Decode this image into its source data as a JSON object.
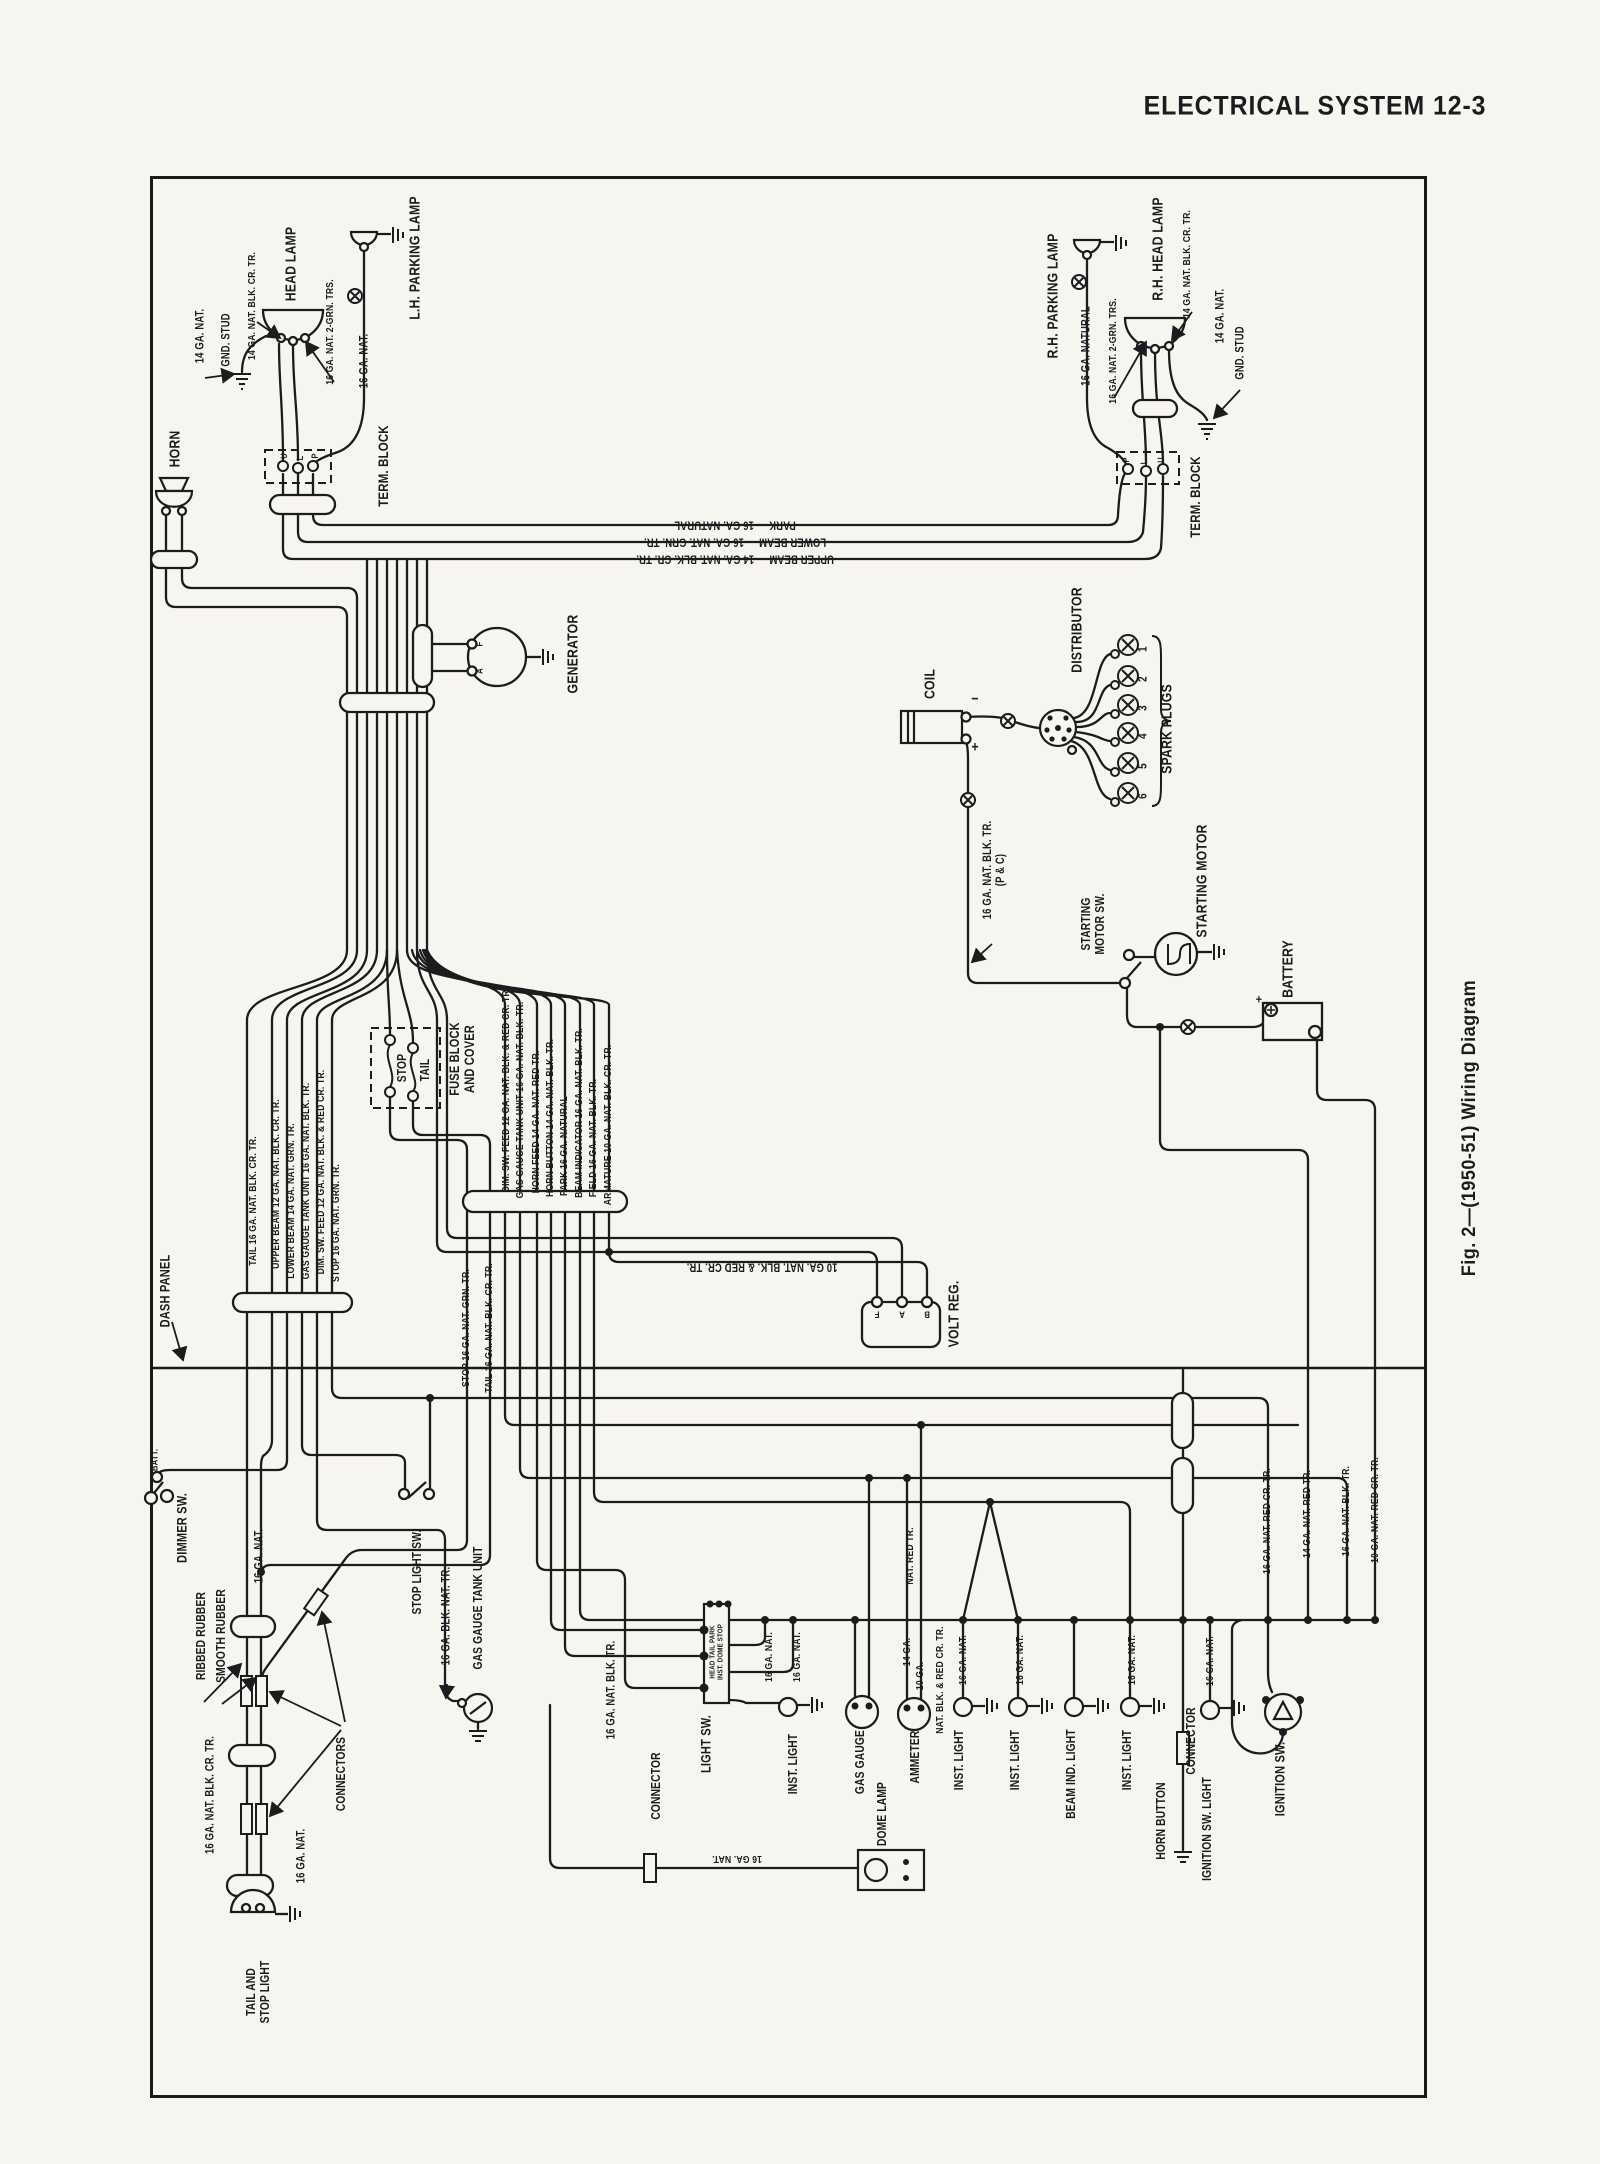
{
  "page": {
    "header": "ELECTRICAL SYSTEM 12-3",
    "caption": "Fig. 2—(1950-51) Wiring Diagram",
    "paper_color": "#f7f5f0",
    "ink_color": "#1c1b1d"
  },
  "labels": [
    {
      "t": "HEAD LAMP",
      "x": 292,
      "y": 264,
      "s": 15,
      "n": "lh-head-lamp-label"
    },
    {
      "t": "L.H. PARKING LAMP",
      "x": 416,
      "y": 258,
      "s": 15,
      "n": "lh-parking-lamp-label"
    },
    {
      "t": "14 GA. NAT.",
      "x": 201,
      "y": 336
    },
    {
      "t": "GND. STUD",
      "x": 227,
      "y": 340,
      "n": "lh-ground-stud-label"
    },
    {
      "t": "14 GA. NAT. BLK. CR. TR.",
      "x": 253,
      "y": 306,
      "s": 10.5
    },
    {
      "t": "16 GA. NAT. 2-GRN. TRS.",
      "x": 331,
      "y": 332,
      "s": 10.5
    },
    {
      "t": "16 GA. NAT.",
      "x": 365,
      "y": 361
    },
    {
      "t": "HORN",
      "x": 176,
      "y": 449,
      "s": 15,
      "n": "horn-label"
    },
    {
      "t": "TERM. BLOCK",
      "x": 384,
      "y": 466,
      "s": 14,
      "n": "lh-term-block-label"
    },
    {
      "t": "U",
      "x": 284,
      "y": 456,
      "s": 9
    },
    {
      "t": "L",
      "x": 300,
      "y": 458,
      "s": 9
    },
    {
      "t": "P",
      "x": 315,
      "y": 456,
      "s": 9
    },
    {
      "t": "PARK — 16 GA. NATURAL",
      "x": 735,
      "y": 524,
      "r": 180
    },
    {
      "t": "LOWER BEAM — 16 GA. NAT. GRN. TR.",
      "x": 735,
      "y": 541,
      "r": 180
    },
    {
      "t": "UPPER BEAM — 14 GA. NAT. BLK. CR. TR.",
      "x": 735,
      "y": 558,
      "r": 180
    },
    {
      "t": "GENERATOR",
      "x": 574,
      "y": 654,
      "s": 15,
      "n": "generator-label"
    },
    {
      "t": "F",
      "x": 481,
      "y": 644,
      "s": 9.5
    },
    {
      "t": "A",
      "x": 481,
      "y": 671,
      "s": 9.5
    },
    {
      "t": "R.H. PARKING LAMP",
      "x": 1054,
      "y": 296,
      "s": 15,
      "n": "rh-parking-lamp-label"
    },
    {
      "t": "R.H. HEAD LAMP",
      "x": 1159,
      "y": 249,
      "s": 15,
      "n": "rh-head-lamp-label"
    },
    {
      "t": "16 GA. NATURAL",
      "x": 1087,
      "y": 346
    },
    {
      "t": "16 GA. NAT. 2-GRN. TRS.",
      "x": 1114,
      "y": 351,
      "s": 10.5
    },
    {
      "t": "14 GA. NAT. BLK. CR. TR.",
      "x": 1188,
      "y": 264,
      "s": 10.5
    },
    {
      "t": "14 GA. NAT.",
      "x": 1221,
      "y": 316
    },
    {
      "t": "GND. STUD",
      "x": 1241,
      "y": 353,
      "n": "rh-ground-stud-label"
    },
    {
      "t": "TERM. BLOCK",
      "x": 1196,
      "y": 497,
      "s": 14,
      "n": "rh-term-block-label"
    },
    {
      "t": "P",
      "x": 1126,
      "y": 460,
      "s": 9
    },
    {
      "t": "L",
      "x": 1144,
      "y": 462,
      "s": 9
    },
    {
      "t": "U",
      "x": 1161,
      "y": 460,
      "s": 9
    },
    {
      "t": "COIL",
      "x": 931,
      "y": 684,
      "s": 15,
      "n": "coil-label"
    },
    {
      "t": "−",
      "x": 975,
      "y": 700,
      "r": 0,
      "s": 15
    },
    {
      "t": "+",
      "x": 975,
      "y": 748,
      "r": 0,
      "s": 15
    },
    {
      "t": "DISTRIBUTOR",
      "x": 1078,
      "y": 630,
      "s": 15,
      "n": "distributor-label"
    },
    {
      "t": "SPARK PLUGS",
      "x": 1168,
      "y": 729,
      "s": 15,
      "n": "spark-plugs-label"
    },
    {
      "t": "1",
      "x": 1143,
      "y": 649,
      "s": 12
    },
    {
      "t": "2",
      "x": 1143,
      "y": 679,
      "s": 12
    },
    {
      "t": "3",
      "x": 1143,
      "y": 708,
      "s": 12
    },
    {
      "t": "4",
      "x": 1143,
      "y": 736,
      "s": 12
    },
    {
      "t": "5",
      "x": 1143,
      "y": 766,
      "s": 12
    },
    {
      "t": "6",
      "x": 1143,
      "y": 796,
      "s": 12
    },
    {
      "t": "16 GA. NAT. BLK. TR.\n(P & C)",
      "x": 995,
      "y": 870
    },
    {
      "t": "STARTING\nMOTOR SW.",
      "x": 1093,
      "y": 924,
      "s": 12.5,
      "n": "starting-motor-switch-label"
    },
    {
      "t": "STARTING MOTOR",
      "x": 1203,
      "y": 881,
      "s": 15,
      "n": "starting-motor-label"
    },
    {
      "t": "BATTERY",
      "x": 1289,
      "y": 969,
      "s": 15,
      "n": "battery-label"
    },
    {
      "t": "+",
      "x": 1259,
      "y": 1000,
      "r": 0,
      "s": 13
    },
    {
      "t": "VOLT REG.",
      "x": 955,
      "y": 1314,
      "s": 15,
      "n": "voltage-regulator-label"
    },
    {
      "t": "10 GA. NAT. BLK. & RED CR. TR.",
      "x": 762,
      "y": 1266,
      "r": 180
    },
    {
      "t": "F",
      "x": 877,
      "y": 1313,
      "r": 180,
      "s": 9.5
    },
    {
      "t": "A",
      "x": 902,
      "y": 1313,
      "r": 180,
      "s": 9.5
    },
    {
      "t": "B",
      "x": 927,
      "y": 1313,
      "r": 180,
      "s": 9.5
    },
    {
      "t": "STOP",
      "x": 402,
      "y": 1068,
      "s": 12.5
    },
    {
      "t": "TAIL",
      "x": 425,
      "y": 1070,
      "s": 12.5
    },
    {
      "t": "FUSE BLOCK\nAND COVER",
      "x": 462,
      "y": 1059,
      "s": 13.5,
      "n": "fuse-block-label"
    },
    {
      "t": "DIM. SW. FEED 12 GA. NAT. BLK. & RED CR. TR.",
      "x": 507,
      "y": 1090,
      "s": 10.5
    },
    {
      "t": "GAS GAUGE TANK UNIT 16 GA. NAT. BLK. TR.",
      "x": 521,
      "y": 1100,
      "s": 10.5
    },
    {
      "t": "HORN FEED 14 GA. NAT. RED TR.",
      "x": 537,
      "y": 1122,
      "s": 10.5
    },
    {
      "t": "HORN BUTTON 14 GA. NAT. BLK. TR.",
      "x": 551,
      "y": 1118,
      "s": 10.5
    },
    {
      "t": "PARK 16 GA. NATURAL",
      "x": 565,
      "y": 1146,
      "s": 10.5
    },
    {
      "t": "BEAM INDICATOR 16 GA. NAT. BLK. TR.",
      "x": 580,
      "y": 1113,
      "s": 10.5
    },
    {
      "t": "FIELD 16 GA. NAT. BLK. TR.",
      "x": 594,
      "y": 1138,
      "s": 10.5
    },
    {
      "t": "ARMATURE 10 GA. NAT. BLK. CR. TR.",
      "x": 609,
      "y": 1125,
      "s": 10.5
    },
    {
      "t": "TAIL 16 GA. NAT. BLK. CR. TR.",
      "x": 254,
      "y": 1201,
      "s": 10.5
    },
    {
      "t": "UPPER BEAM 12 GA. NAT. BLK. CR. TR.",
      "x": 277,
      "y": 1184,
      "s": 10.5
    },
    {
      "t": "LOWER BEAM 14 GA. NAT. GRN. TR.",
      "x": 292,
      "y": 1201,
      "s": 10.5
    },
    {
      "t": "GAS GAUGE TANK UNIT 16 GA. NAT. BLK. TR.",
      "x": 307,
      "y": 1181,
      "s": 10.5
    },
    {
      "t": "DIM. SW. FEED 12 GA. NAT. BLK. & RED CR. TR.",
      "x": 322,
      "y": 1172,
      "s": 10.5
    },
    {
      "t": "STOP 16 GA. NAT. GRN. TR.",
      "x": 337,
      "y": 1223,
      "s": 10.5
    },
    {
      "t": "DASH PANEL",
      "x": 165,
      "y": 1291,
      "s": 13.5,
      "n": "dash-panel-label"
    },
    {
      "t": "BATT.",
      "x": 156,
      "y": 1460,
      "s": 9.5
    },
    {
      "t": "DIMMER SW.",
      "x": 182,
      "y": 1528,
      "s": 13.5,
      "n": "dimmer-switch-label"
    },
    {
      "t": "16 GA. NAT.",
      "x": 260,
      "y": 1556
    },
    {
      "t": "STOP 16 GA. NAT. GRN. TR.",
      "x": 467,
      "y": 1328,
      "s": 10.5
    },
    {
      "t": "TAIL 16 GA. NAT. BLK. CR. TR.",
      "x": 490,
      "y": 1328,
      "s": 10.5
    },
    {
      "t": "RIBBED RUBBER",
      "x": 201,
      "y": 1636,
      "s": 12.5
    },
    {
      "t": "SMOOTH RUBBER",
      "x": 221,
      "y": 1636,
      "s": 12.5
    },
    {
      "t": "16 GA. NAT. BLK. CR. TR.",
      "x": 211,
      "y": 1795
    },
    {
      "t": "16 GA. NAT.",
      "x": 302,
      "y": 1856
    },
    {
      "t": "CONNECTORS",
      "x": 341,
      "y": 1774,
      "s": 12.5,
      "n": "connectors-label"
    },
    {
      "t": "TAIL AND\nSTOP LIGHT",
      "x": 258,
      "y": 1992,
      "s": 12.5,
      "n": "tail-stop-light-label"
    },
    {
      "t": "STOP LIGHT SW.",
      "x": 417,
      "y": 1572,
      "s": 12.5,
      "n": "stop-light-switch-label"
    },
    {
      "t": "16 GA. BLK. NAT. TR.",
      "x": 447,
      "y": 1616
    },
    {
      "t": "GAS GAUGE TANK UNIT",
      "x": 478,
      "y": 1608,
      "s": 12.5,
      "n": "gas-gauge-tank-unit-label"
    },
    {
      "t": "16 GA. NAT. BLK. TR.",
      "x": 612,
      "y": 1690
    },
    {
      "t": "LIGHT SW.",
      "x": 706,
      "y": 1744,
      "s": 13.5,
      "n": "light-switch-label"
    },
    {
      "t": "HEAD TAIL PARK\nINST. DOME STOP",
      "x": 717,
      "y": 1652,
      "s": 7.5,
      "n": "light-switch-positions-label"
    },
    {
      "t": "16 GA. NAT.",
      "x": 770,
      "y": 1657,
      "s": 10.5
    },
    {
      "t": "16 GA. NAT.",
      "x": 798,
      "y": 1657,
      "s": 10.5
    },
    {
      "t": "INST. LIGHT",
      "x": 793,
      "y": 1764,
      "s": 12.5,
      "n": "inst-light-label"
    },
    {
      "t": "GAS GAUGE",
      "x": 860,
      "y": 1762,
      "s": 12.5,
      "n": "gas-gauge-label"
    },
    {
      "t": "CONNECTOR",
      "x": 656,
      "y": 1786,
      "s": 12.5,
      "n": "dome-connector-label"
    },
    {
      "t": "16 GA. NAT.",
      "x": 737,
      "y": 1858,
      "r": 180,
      "s": 10.5
    },
    {
      "t": "DOME LAMP",
      "x": 882,
      "y": 1814,
      "s": 12.5,
      "n": "dome-lamp-label"
    },
    {
      "t": "AMMETER",
      "x": 915,
      "y": 1757,
      "s": 12.5,
      "n": "ammeter-label"
    },
    {
      "t": "14 GA.",
      "x": 908,
      "y": 1652,
      "s": 10.5
    },
    {
      "t": "10 GA.",
      "x": 921,
      "y": 1676,
      "s": 10.5
    },
    {
      "t": "NAT. RED TR.",
      "x": 911,
      "y": 1556,
      "s": 10.5
    },
    {
      "t": "NAT. BLK. & RED CR. TR.",
      "x": 941,
      "y": 1680,
      "s": 10.5
    },
    {
      "t": "16 GA. NAT.",
      "x": 964,
      "y": 1660,
      "s": 10.5
    },
    {
      "t": "INST. LIGHT",
      "x": 959,
      "y": 1760,
      "s": 12.5,
      "n": "inst-light-label"
    },
    {
      "t": "16 GA. NAT.",
      "x": 1021,
      "y": 1660,
      "s": 10.5
    },
    {
      "t": "INST. LIGHT",
      "x": 1015,
      "y": 1760,
      "s": 12.5,
      "n": "inst-light-label"
    },
    {
      "t": "BEAM IND. LIGHT",
      "x": 1071,
      "y": 1774,
      "s": 12.5,
      "n": "beam-indicator-light-label"
    },
    {
      "t": "16 GA. NAT.",
      "x": 1133,
      "y": 1660,
      "s": 10.5
    },
    {
      "t": "INST. LIGHT",
      "x": 1127,
      "y": 1760,
      "s": 12.5,
      "n": "inst-light-label"
    },
    {
      "t": "CONNECTOR",
      "x": 1191,
      "y": 1741,
      "s": 12.5,
      "n": "horn-connector-label"
    },
    {
      "t": "HORN BUTTON",
      "x": 1161,
      "y": 1821,
      "s": 12.5,
      "n": "horn-button-label"
    },
    {
      "t": "IGNITION SW. LIGHT",
      "x": 1207,
      "y": 1829,
      "s": 12.5,
      "n": "ignition-switch-light-label"
    },
    {
      "t": "16 GA. NAT.",
      "x": 1211,
      "y": 1661,
      "s": 10.5
    },
    {
      "t": "IGNITION SW.",
      "x": 1280,
      "y": 1779,
      "s": 13.5,
      "n": "ignition-switch-label"
    },
    {
      "t": "16 GA. NAT. RED CR. TR.",
      "x": 1268,
      "y": 1521,
      "s": 10.5
    },
    {
      "t": "14 GA. NAT. RED TR.",
      "x": 1308,
      "y": 1514,
      "s": 10.5
    },
    {
      "t": "16 GA. NAT. BLK. TR.",
      "x": 1347,
      "y": 1511,
      "s": 10.5
    },
    {
      "t": "10 GA. NAT. RED CR. TR.",
      "x": 1376,
      "y": 1510,
      "s": 10.5
    }
  ]
}
